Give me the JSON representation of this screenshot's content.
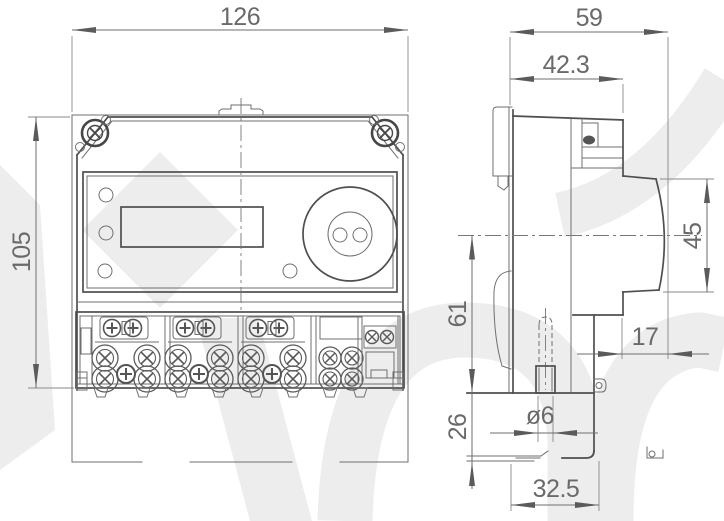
{
  "drawing_type": "meter-dimensional-drawing",
  "dimensions": {
    "front_width": "126",
    "front_height": "105",
    "side_depth": "59",
    "side_upper_depth": "42.3",
    "cover_bulge_height": "45",
    "center_to_bottom": "61",
    "clip_drop": "26",
    "cover_protrusion": "17",
    "pin_diameter": "ø6",
    "base_bottom_depth": "32.5"
  },
  "colors": {
    "outline": "#4f4f4f",
    "dimension_lines": "#6e6e6e",
    "dimension_text": "#6a6a6a",
    "watermark": "#ededed",
    "background": "#ffffff"
  }
}
